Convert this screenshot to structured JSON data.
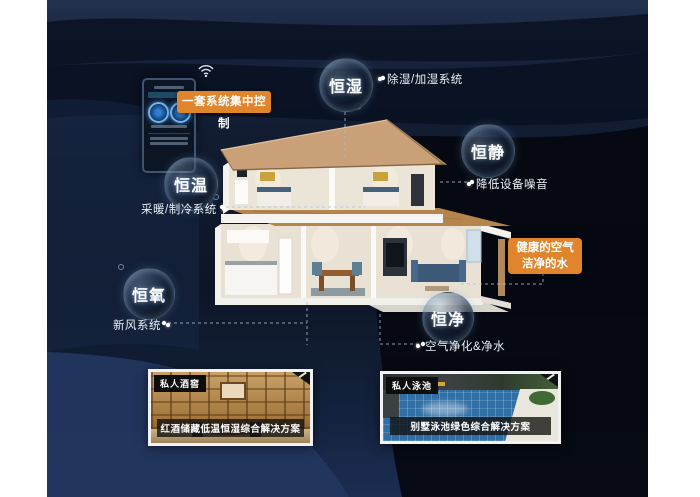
{
  "control": {
    "label": "一套系统集中控制"
  },
  "bubbles": {
    "hengshi": {
      "label": "恒湿",
      "note": "除湿/加湿系统"
    },
    "hengjing": {
      "label": "恒静",
      "note": "降低设备噪音"
    },
    "hengwen": {
      "label": "恒温",
      "note": "采暖/制冷系统"
    },
    "hengyang": {
      "label": "恒氧",
      "note": "新风系统"
    },
    "hengjin": {
      "label": "恒净",
      "note": "空气净化&净水"
    }
  },
  "highlight": {
    "line1": "健康的空气",
    "line2": "洁净的水"
  },
  "cards": {
    "wine": {
      "badge": "私人酒窖",
      "caption": "红酒储藏低温恒湿综合解决方案"
    },
    "pool": {
      "badge": "私人泳池",
      "caption": "别墅泳池绿色综合解决方案"
    }
  },
  "colors": {
    "accent_orange": "#e0852c",
    "background_navy": "#101b30",
    "bubble_rim": "#9fb6c9",
    "pool_water": "#2f6fa6",
    "wood": "#a2763c"
  }
}
